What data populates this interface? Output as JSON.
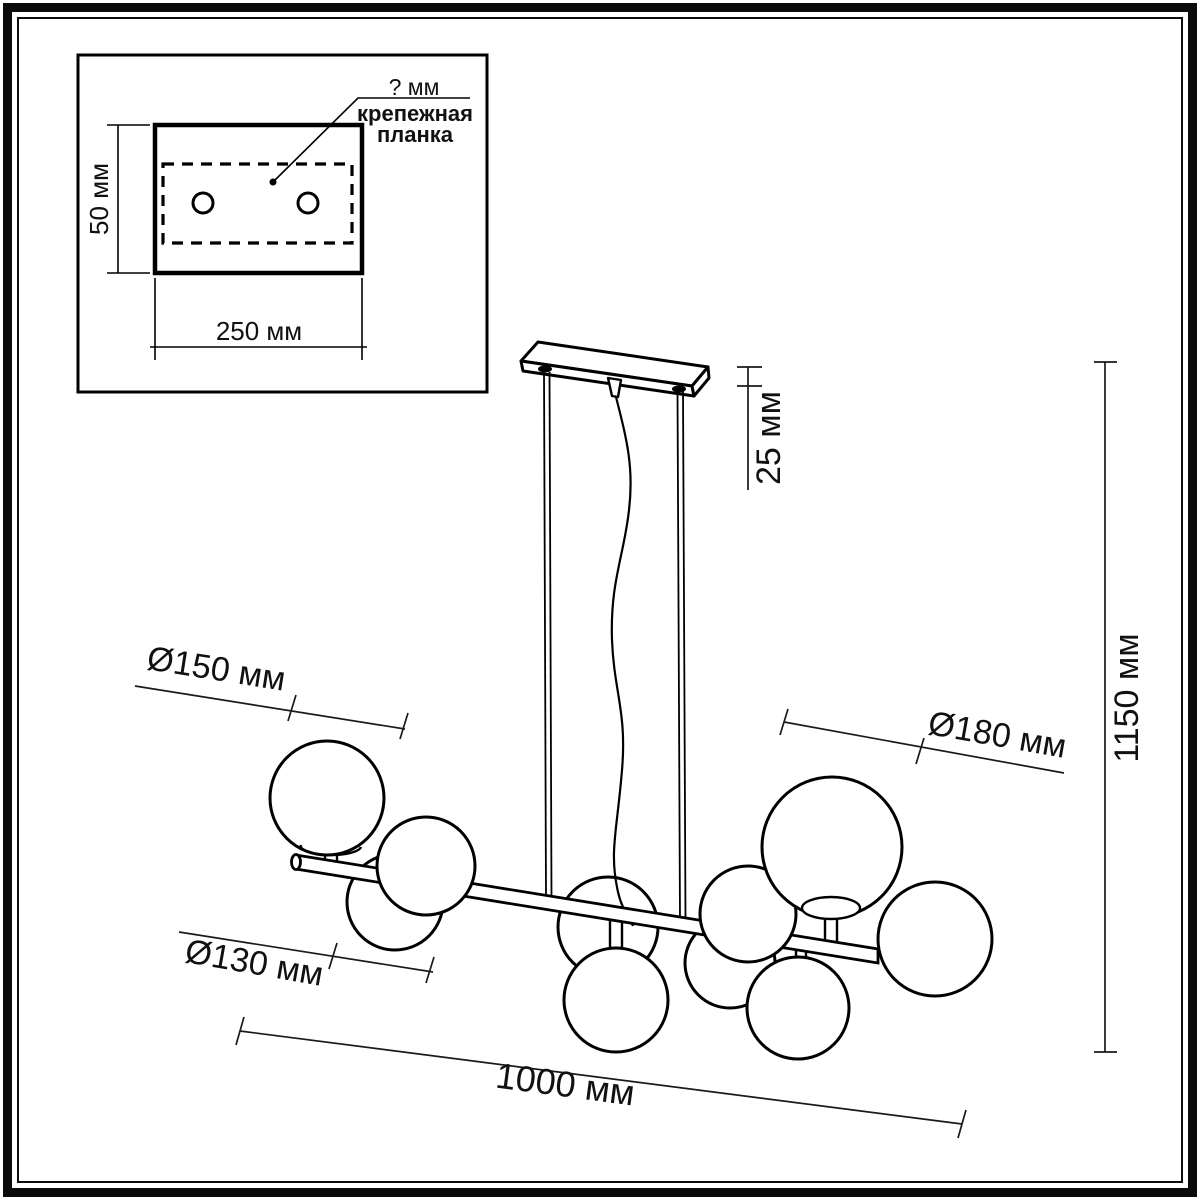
{
  "inset": {
    "plate_width_label": "250 мм",
    "plate_height_label": "50 мм",
    "hole_spacing_label": "? мм",
    "bracket_label_line1": "крепежная",
    "bracket_label_line2": "планка"
  },
  "fixture": {
    "canopy_drop_label": "25 мм",
    "overall_height_label": "1150 мм",
    "overall_length_label": "1000 мм",
    "globe_large_label": "Ø180 мм",
    "globe_medium_label": "Ø150 мм",
    "globe_small_label": "Ø130 мм",
    "globe_count": 10,
    "line_color": "#000000",
    "background_color": "#ffffff"
  }
}
